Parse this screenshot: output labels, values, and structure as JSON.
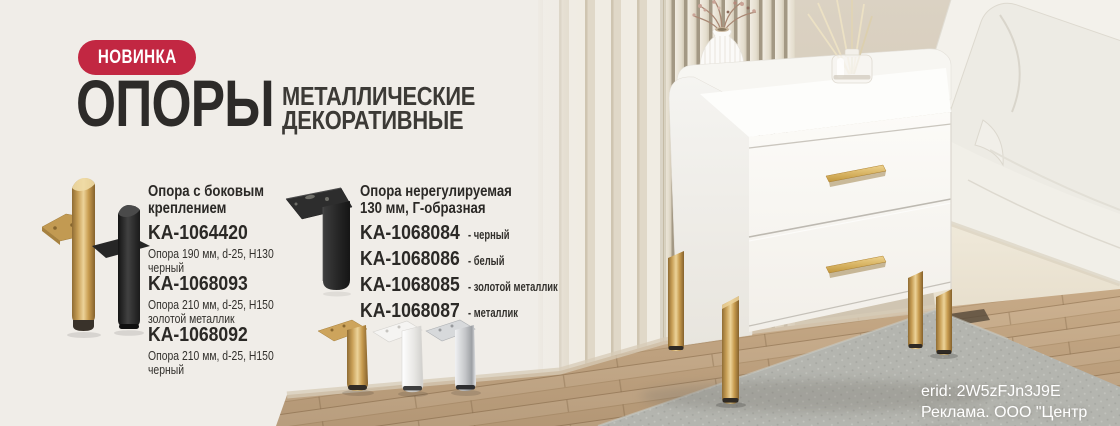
{
  "badge": {
    "label": "НОВИНКА"
  },
  "title": {
    "main": "ОПОРЫ",
    "subtitle_line1": "МЕТАЛЛИЧЕСКИЕ",
    "subtitle_line2": "ДЕКОРАТИВНЫЕ"
  },
  "columns": [
    {
      "header_line1": "Опора с боковым",
      "header_line2": "креплением",
      "products": [
        {
          "code": "KA-1064420",
          "desc_line1": "Опора 190 мм, d-25, H130",
          "desc_line2": "черный"
        },
        {
          "code": "KA-1068093",
          "desc_line1": "Опора 210 мм, d-25, H150",
          "desc_line2": "золотой металлик"
        },
        {
          "code": "KA-1068092",
          "desc_line1": "Опора 210 мм, d-25, H150",
          "desc_line2": "черный"
        }
      ]
    },
    {
      "header_line1": "Опора нерегулируемая",
      "header_line2": "130 мм, Г-образная",
      "products": [
        {
          "code": "KA-1068084",
          "suffix": "- черный"
        },
        {
          "code": "KA-1068086",
          "suffix": "- белый"
        },
        {
          "code": "KA-1068085",
          "suffix": "- золотой металлик"
        },
        {
          "code": "KA-1068087",
          "suffix": "- металлик"
        }
      ]
    }
  ],
  "legal": {
    "erid": "erid: 2W5zFJn3J9E",
    "advertiser": "Реклама. ООО \"Центр КДМ\""
  },
  "colors": {
    "badge_bg": "#c22742",
    "title_text": "#2d2b29",
    "background": "#f0ede8",
    "gold": "#c9a25a",
    "wall_beige": "#d5cabb",
    "rug_gray": "#b6b7b1"
  }
}
